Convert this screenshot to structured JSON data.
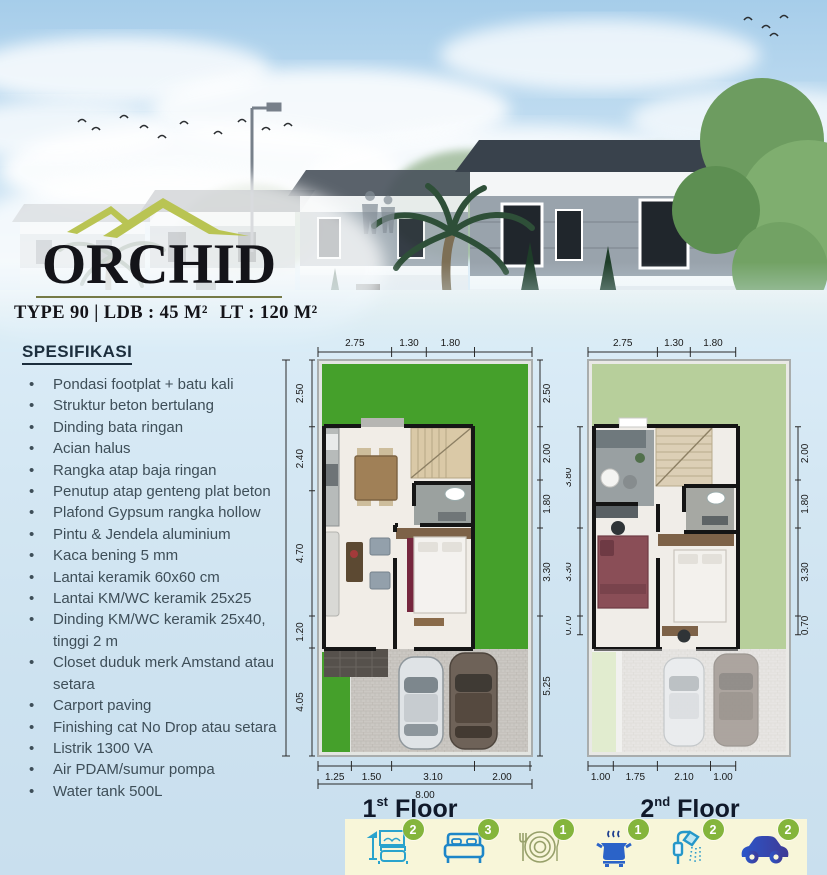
{
  "logo": {
    "title": "ORCHID",
    "subtitle_left": "TYPE 90 | LDB : 45 M²",
    "subtitle_right": "LT : 120 M²"
  },
  "specs": {
    "heading": "SPESIFIKASI",
    "items": [
      "Pondasi footplat + batu kali",
      "Struktur beton bertulang",
      "Dinding bata ringan",
      "Acian halus",
      "Rangka atap baja ringan",
      "Penutup atap genteng plat beton",
      "Plafond Gypsum rangka hollow",
      "Pintu & Jendela aluminium",
      "Kaca bening 5 mm",
      "Lantai keramik 60x60 cm",
      "Lantai KM/WC keramik 25x25",
      "Dinding KM/WC keramik 25x40, tinggi 2 m",
      "Closet duduk merk Amstand atau setara",
      "Carport paving",
      "Finishing cat No Drop atau setara",
      "Listrik 1300 VA",
      "Air PDAM/sumur pompa",
      "Water tank 500L"
    ]
  },
  "floors": {
    "first": {
      "label_num": "1",
      "label_ord": "st",
      "label_word": "Floor",
      "dims": {
        "top": [
          "2.75",
          "1.30",
          "1.80"
        ],
        "left": [
          "2.50",
          "2.40",
          "4.70",
          "1.20",
          "4.05"
        ],
        "left_total": "15.00",
        "right": [
          "2.50",
          "2.00",
          "1.80",
          "3.30",
          "5.25"
        ],
        "bottom": [
          "1.25",
          "1.50",
          "3.10",
          "2.00"
        ],
        "bottom_total": "8.00"
      }
    },
    "second": {
      "label_num": "2",
      "label_ord": "nd",
      "label_word": "Floor",
      "dims": {
        "top": [
          "2.75",
          "1.30",
          "1.80"
        ],
        "left": [
          "3.80",
          "3.30",
          "0.70"
        ],
        "right": [
          "2.00",
          "1.80",
          "3.30",
          "0.70"
        ],
        "bottom": [
          "1.00",
          "1.75",
          "2.10",
          "1.00"
        ]
      }
    }
  },
  "amenities": {
    "items": [
      {
        "icon": "living-room-icon",
        "count": "2"
      },
      {
        "icon": "bed-icon",
        "count": "3"
      },
      {
        "icon": "dining-plate-icon",
        "count": "1"
      },
      {
        "icon": "cooking-pot-icon",
        "count": "1"
      },
      {
        "icon": "shower-icon",
        "count": "2"
      },
      {
        "icon": "car-icon",
        "count": "2"
      }
    ]
  },
  "colors": {
    "accent_olive": "#b9c453",
    "lawn_green": "#45a02b",
    "soft_green": "#b7cf9b",
    "badge_green": "#84b53c",
    "icon_blue": "#2b56c9",
    "strip_bg": "#f8f6d9",
    "text_dark": "#1c2e3d"
  }
}
